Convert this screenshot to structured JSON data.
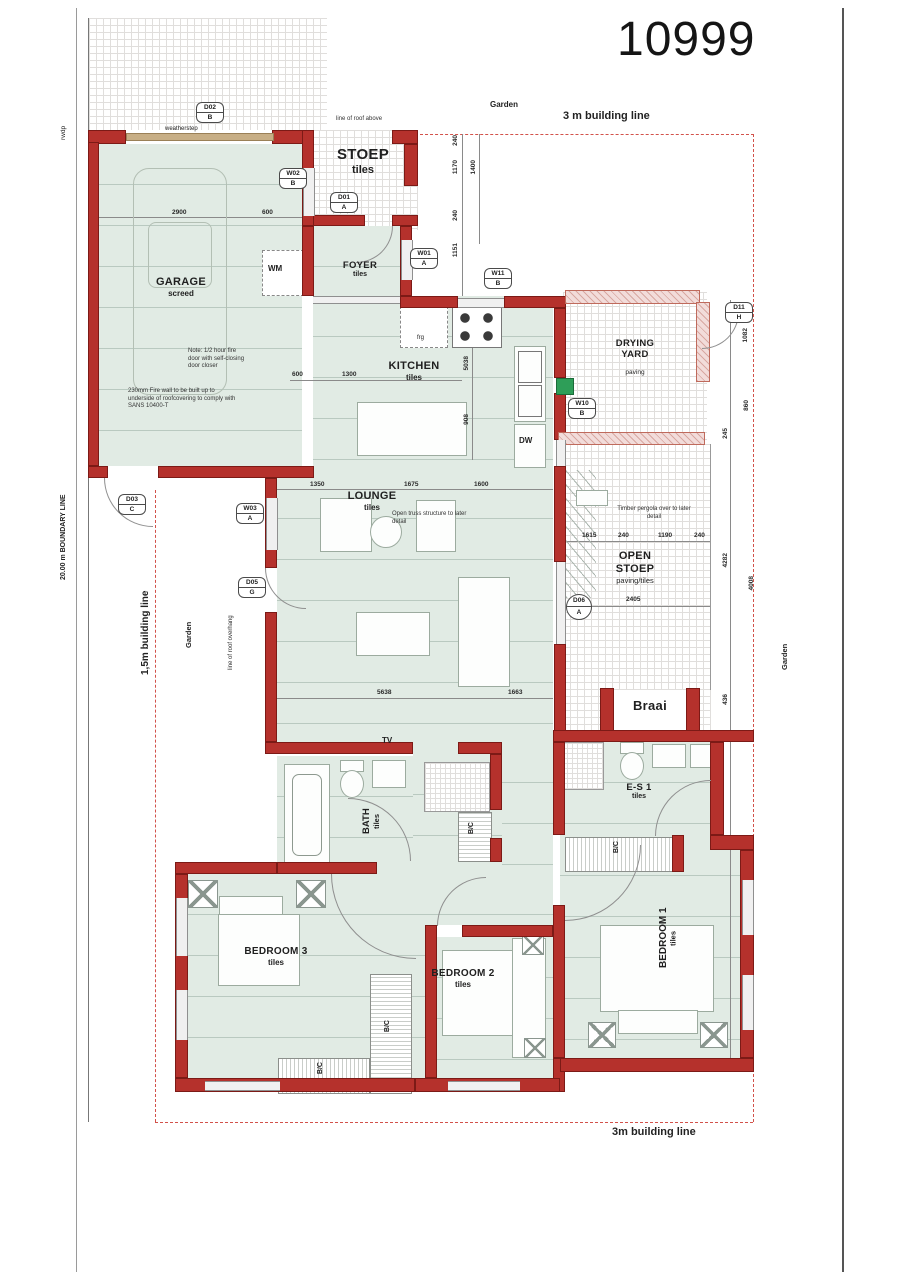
{
  "title": "10999",
  "site": {
    "garden_top": "Garden",
    "garden_left": "Garden",
    "garden_right": "Garden",
    "building_line_top": "3 m building line",
    "building_line_bottom": "3m building line",
    "building_line_left": "1,5m building line",
    "boundary_line_left": "20.00 m BOUNDARY LINE",
    "rwdp": "rwdp",
    "roof_note_top": "line of roof above",
    "roof_note_left": "line of roof overhang"
  },
  "rooms": {
    "garage": {
      "name": "GARAGE",
      "finish": "screed"
    },
    "stoep": {
      "name": "STOEP",
      "finish": "tiles"
    },
    "foyer": {
      "name": "FOYER",
      "finish": "tiles"
    },
    "kitchen": {
      "name": "KITCHEN",
      "finish": "tiles"
    },
    "drying_yard": {
      "name": "DRYING",
      "name2": "YARD",
      "finish": "paving"
    },
    "lounge": {
      "name": "LOUNGE",
      "finish": "tiles",
      "note": "Open truss structure to later detail"
    },
    "open_stoep": {
      "name": "OPEN",
      "name2": "STOEP",
      "finish": "paving/tiles",
      "note": "Timber pergola over to later detail"
    },
    "braai": {
      "name": "Braai"
    },
    "es1": {
      "name": "E-S 1",
      "finish": "tiles"
    },
    "bath": {
      "name": "BATH",
      "finish": "tiles"
    },
    "bedroom1": {
      "name": "BEDROOM 1",
      "finish": "tiles"
    },
    "bedroom2": {
      "name": "BEDROOM 2",
      "finish": "tiles"
    },
    "bedroom3": {
      "name": "BEDROOM 3",
      "finish": "tiles"
    }
  },
  "fixtures": {
    "wm": "WM",
    "dw": "DW",
    "frg": "frg",
    "tv": "TV",
    "bic": "B/C",
    "weatherstep": "weatherstep"
  },
  "notes": {
    "garage_fire_door": "Note: 1/2 hour fire door with self-closing door closer",
    "garage_fire_wall": "230mm Fire wall to be built up to underside of roofcovering to comply with SANS 10400-T"
  },
  "openings": [
    {
      "code": "D02",
      "rev": "B"
    },
    {
      "code": "W02",
      "rev": "B"
    },
    {
      "code": "D01",
      "rev": "A"
    },
    {
      "code": "W01",
      "rev": "A"
    },
    {
      "code": "W11",
      "rev": "B"
    },
    {
      "code": "D11",
      "rev": "H"
    },
    {
      "code": "W10",
      "rev": "B"
    },
    {
      "code": "D03",
      "rev": "C"
    },
    {
      "code": "W03",
      "rev": "A"
    },
    {
      "code": "D05",
      "rev": "G"
    },
    {
      "code": "D06",
      "rev": "A"
    }
  ],
  "dims": [
    "2900",
    "600",
    "240",
    "1170",
    "1400",
    "240",
    "1151",
    "600",
    "1300",
    "5038",
    "908",
    "1350",
    "1675",
    "1600",
    "5638",
    "1663",
    "1615",
    "240",
    "1190",
    "240",
    "2405",
    "1082",
    "860",
    "245",
    "4282",
    "4008",
    "436"
  ],
  "colors": {
    "wall_red": "#b5312c",
    "room_green": "#e1ebe4",
    "screen_pink": "#f2dcda",
    "gate_green": "#2e9e58",
    "garage_door_tan": "#c7ae85",
    "building_line_red": "#d2524a"
  }
}
